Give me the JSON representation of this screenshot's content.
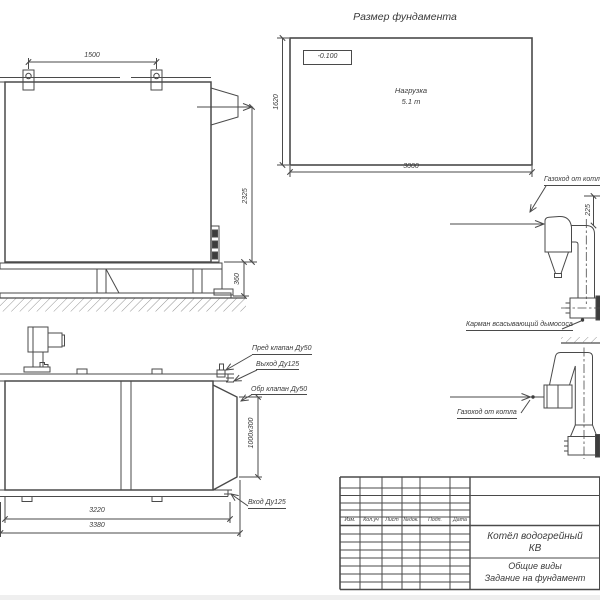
{
  "sheet": {
    "background": "#ffffff",
    "line_color": "#4a4a4a",
    "text_color": "#3a3a3a"
  },
  "foundation_plan": {
    "title": "Размер фундамента",
    "elevation_mark": "-0.100",
    "load_line1": "Нагрузка",
    "load_line2": "5.1 т",
    "dim_length": "3000",
    "dim_width": "1620"
  },
  "side_view": {
    "dim_lug_spacing": "1500",
    "dim_height": "2325",
    "dim_frame_height": "360"
  },
  "plan_view": {
    "callout_safety_valve": "Пред клапан Ду50",
    "callout_outlet": "Выход Ду125",
    "callout_check_valve": "Обр клапан Ду50",
    "callout_inlet": "Вход Ду125",
    "dim_collector": "1000х300",
    "dim_body_length": "3220",
    "dim_overall_length": "3380"
  },
  "flue_upper": {
    "label_duct": "Газоход от котла",
    "label_pocket": "Карман всасывающий дымососа",
    "dim_offset": "225"
  },
  "flue_lower": {
    "label_duct": "Газоход от котла"
  },
  "title_block": {
    "headers": [
      "Изм.",
      "Кол.уч",
      "Лист",
      "№док.",
      "Подп.",
      "Дата"
    ],
    "product_line1": "Котёл водогрейный",
    "product_line2": "КВ",
    "doc_line1": "Общие виды",
    "doc_line2": "Задание на фундамент"
  }
}
